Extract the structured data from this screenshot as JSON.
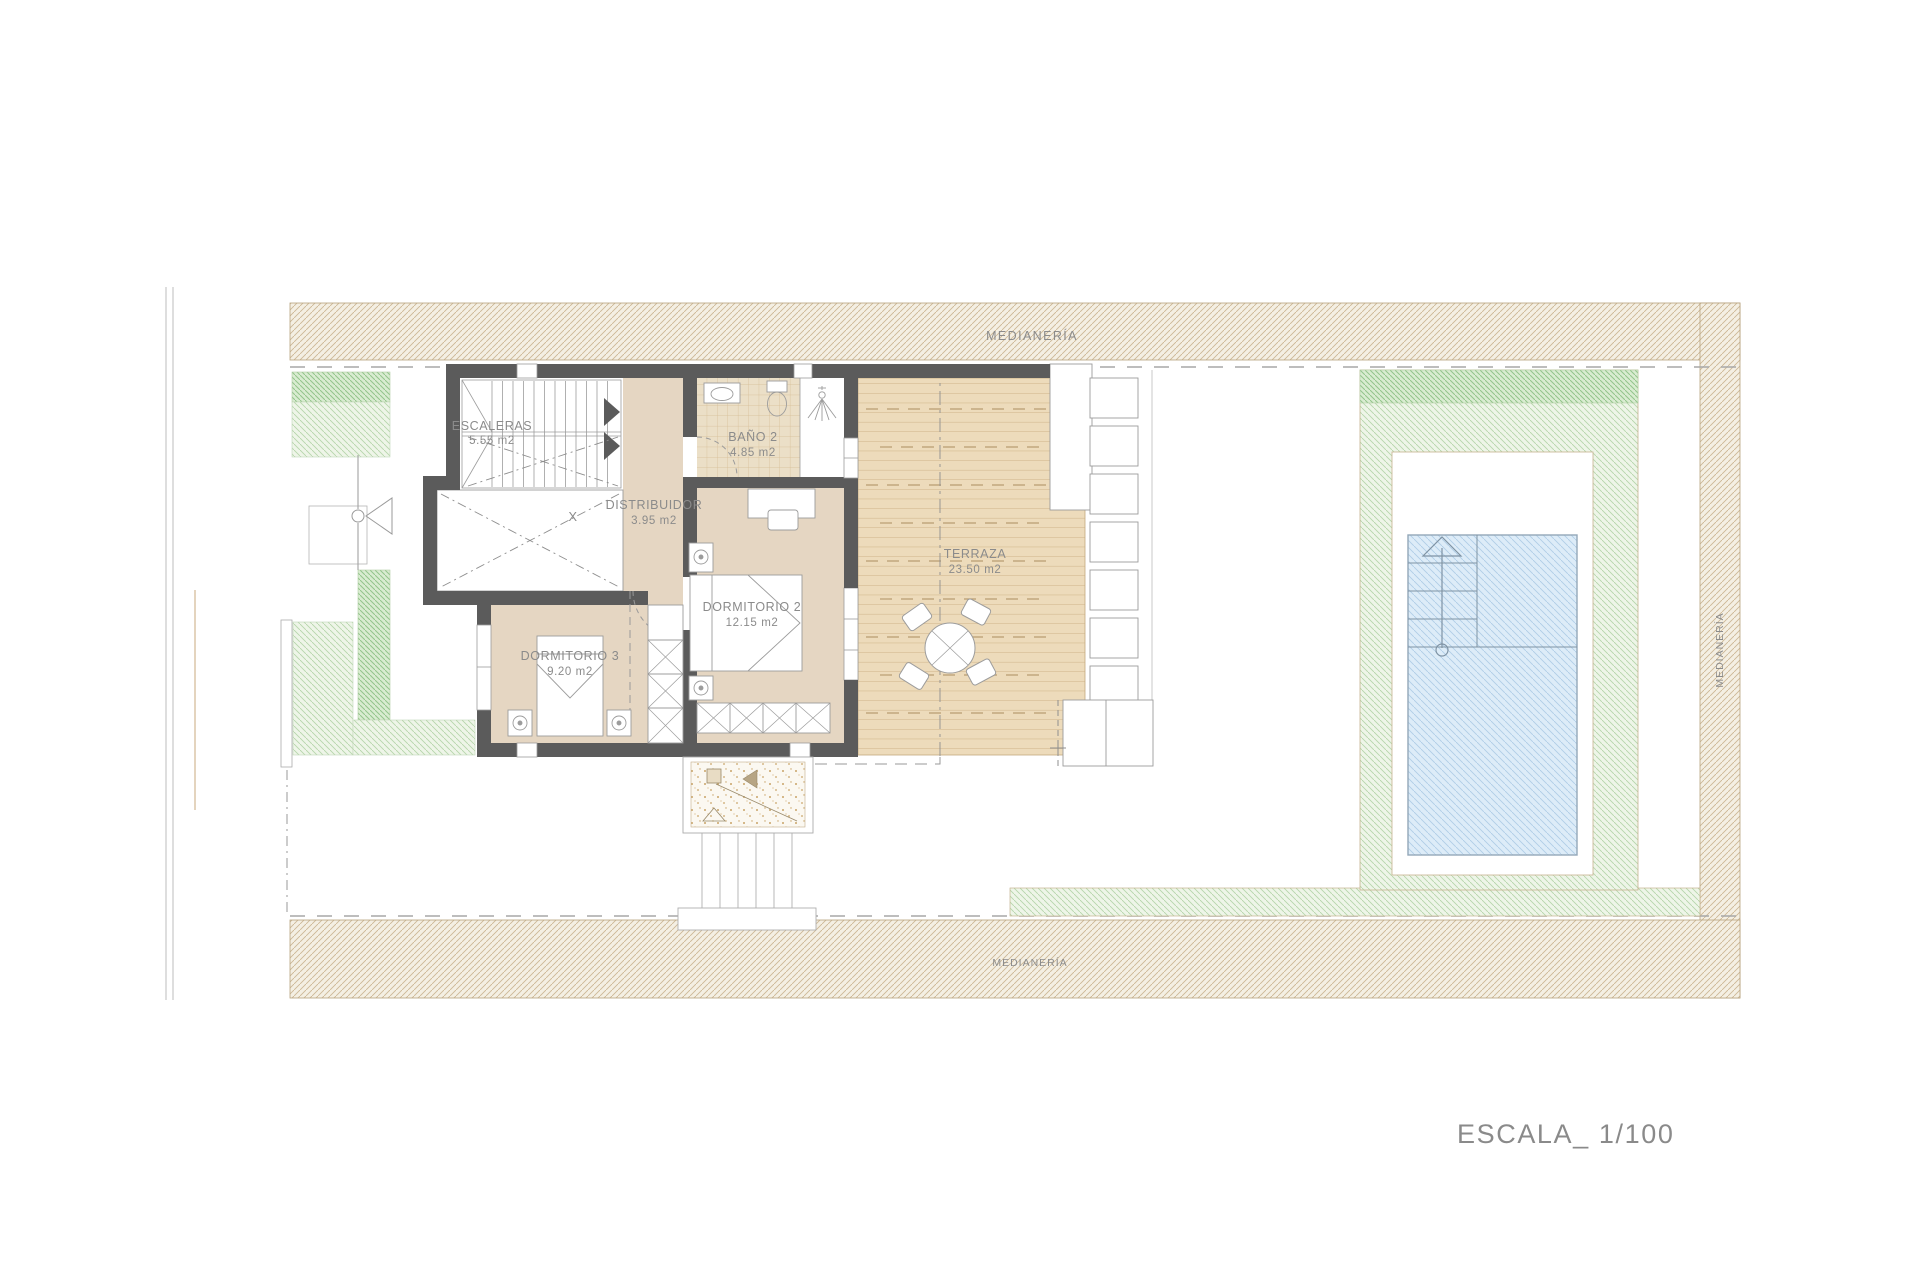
{
  "plan": {
    "scale_label": "ESCALA_ 1/100",
    "boundaries": {
      "top": "MEDIANERÍA",
      "bottom": "MEDIANERÍA",
      "right": "MEDIANERÍA"
    },
    "rooms": [
      {
        "id": "escaleras",
        "name": "ESCALERAS",
        "area": "5.55 m2"
      },
      {
        "id": "bano-2",
        "name": "BAÑO 2",
        "area": "4.85 m2"
      },
      {
        "id": "distribuidor",
        "name": "DISTRIBUIDOR",
        "area": "3.95 m2"
      },
      {
        "id": "dormitorio-2",
        "name": "DORMITORIO 2",
        "area": "12.15 m2"
      },
      {
        "id": "dormitorio-3",
        "name": "DORMITORIO 3",
        "area": "9.20 m2"
      },
      {
        "id": "terraza",
        "name": "TERRAZA",
        "area": "23.50 m2"
      }
    ],
    "void_marker": "X",
    "colors": {
      "wall": "#5b5b5b",
      "floor_tan": "#e5d6c2",
      "deck_wood": "#eddbbb",
      "boundary_hatch": "#cdb795",
      "green_light": "#b7d5ac",
      "green_dark": "#93c48c",
      "pool_blue": "#b0cde7",
      "label_gray": "#8b8b8b"
    }
  }
}
